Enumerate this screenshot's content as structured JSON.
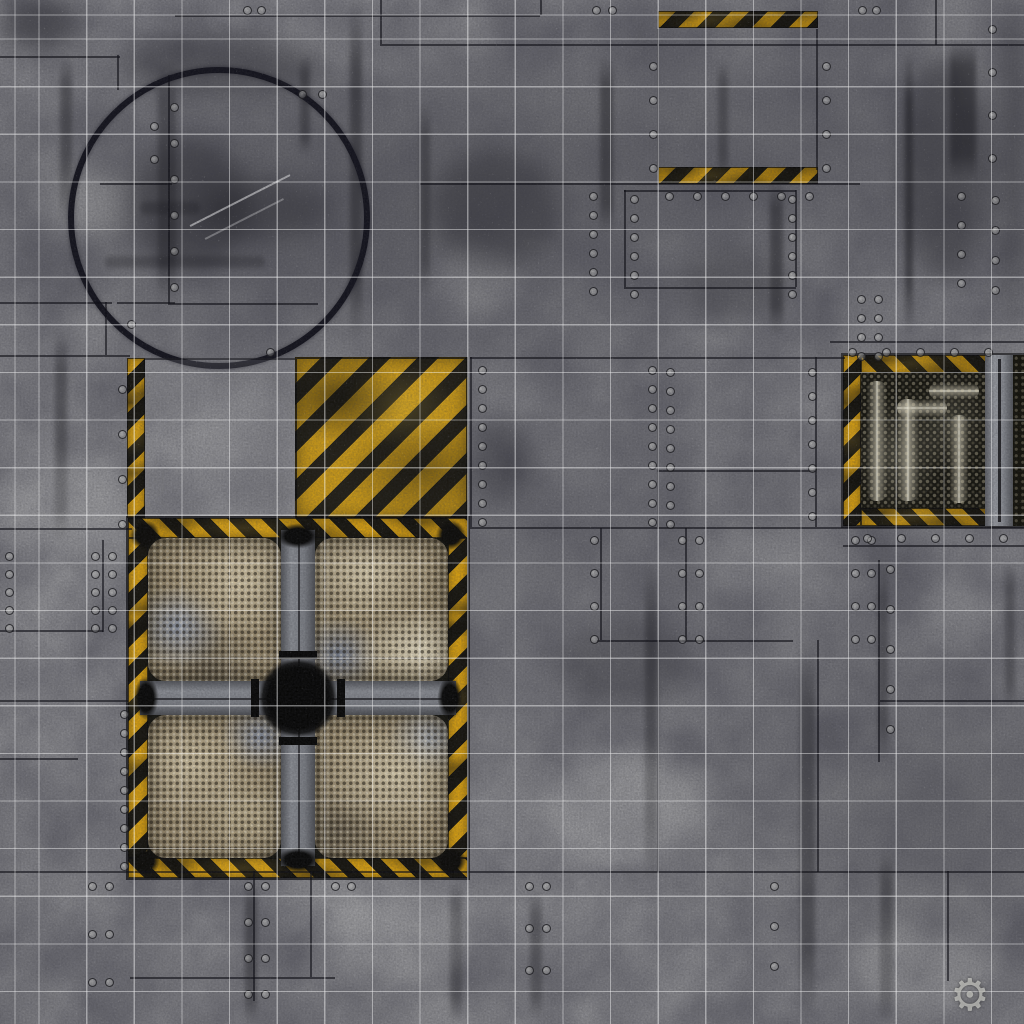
{
  "meta": {
    "title": "Sci-fi industrial battle mat — grid board with hazard zones",
    "type": "game-mat"
  },
  "theme": {
    "base-gray": "#8d8d90",
    "hazard-yellow": "#dfa512",
    "hazard-yellow-bright": "#f2c41f",
    "hazard-dark": "#17150e",
    "grid-line": "#ffffff",
    "circle-stroke": "#12121b",
    "mesh-tan": "#b5a582",
    "beam-gray": "#85888e",
    "vent-dark": "#15140e"
  },
  "grid": {
    "line_count_x": 21,
    "line_count_y": 21,
    "cell_px": 47.6
  },
  "features": {
    "circle_marker": {
      "label": "circular deployment zone marker"
    },
    "doorway": {
      "label": "hazard-striped doorway threshold bars"
    },
    "hazard_square": {
      "label": "yellow-black chevron hazard square"
    },
    "clean_square": {
      "label": "clear floor square with hazard edge strip"
    },
    "fan_unit": {
      "label": "quad industrial fan vent with hazard border"
    },
    "pipe_vent": {
      "label": "pipework grate vent with hazard border"
    },
    "watermark": {
      "glyph": "⚙",
      "label": "maker gear logo"
    }
  }
}
